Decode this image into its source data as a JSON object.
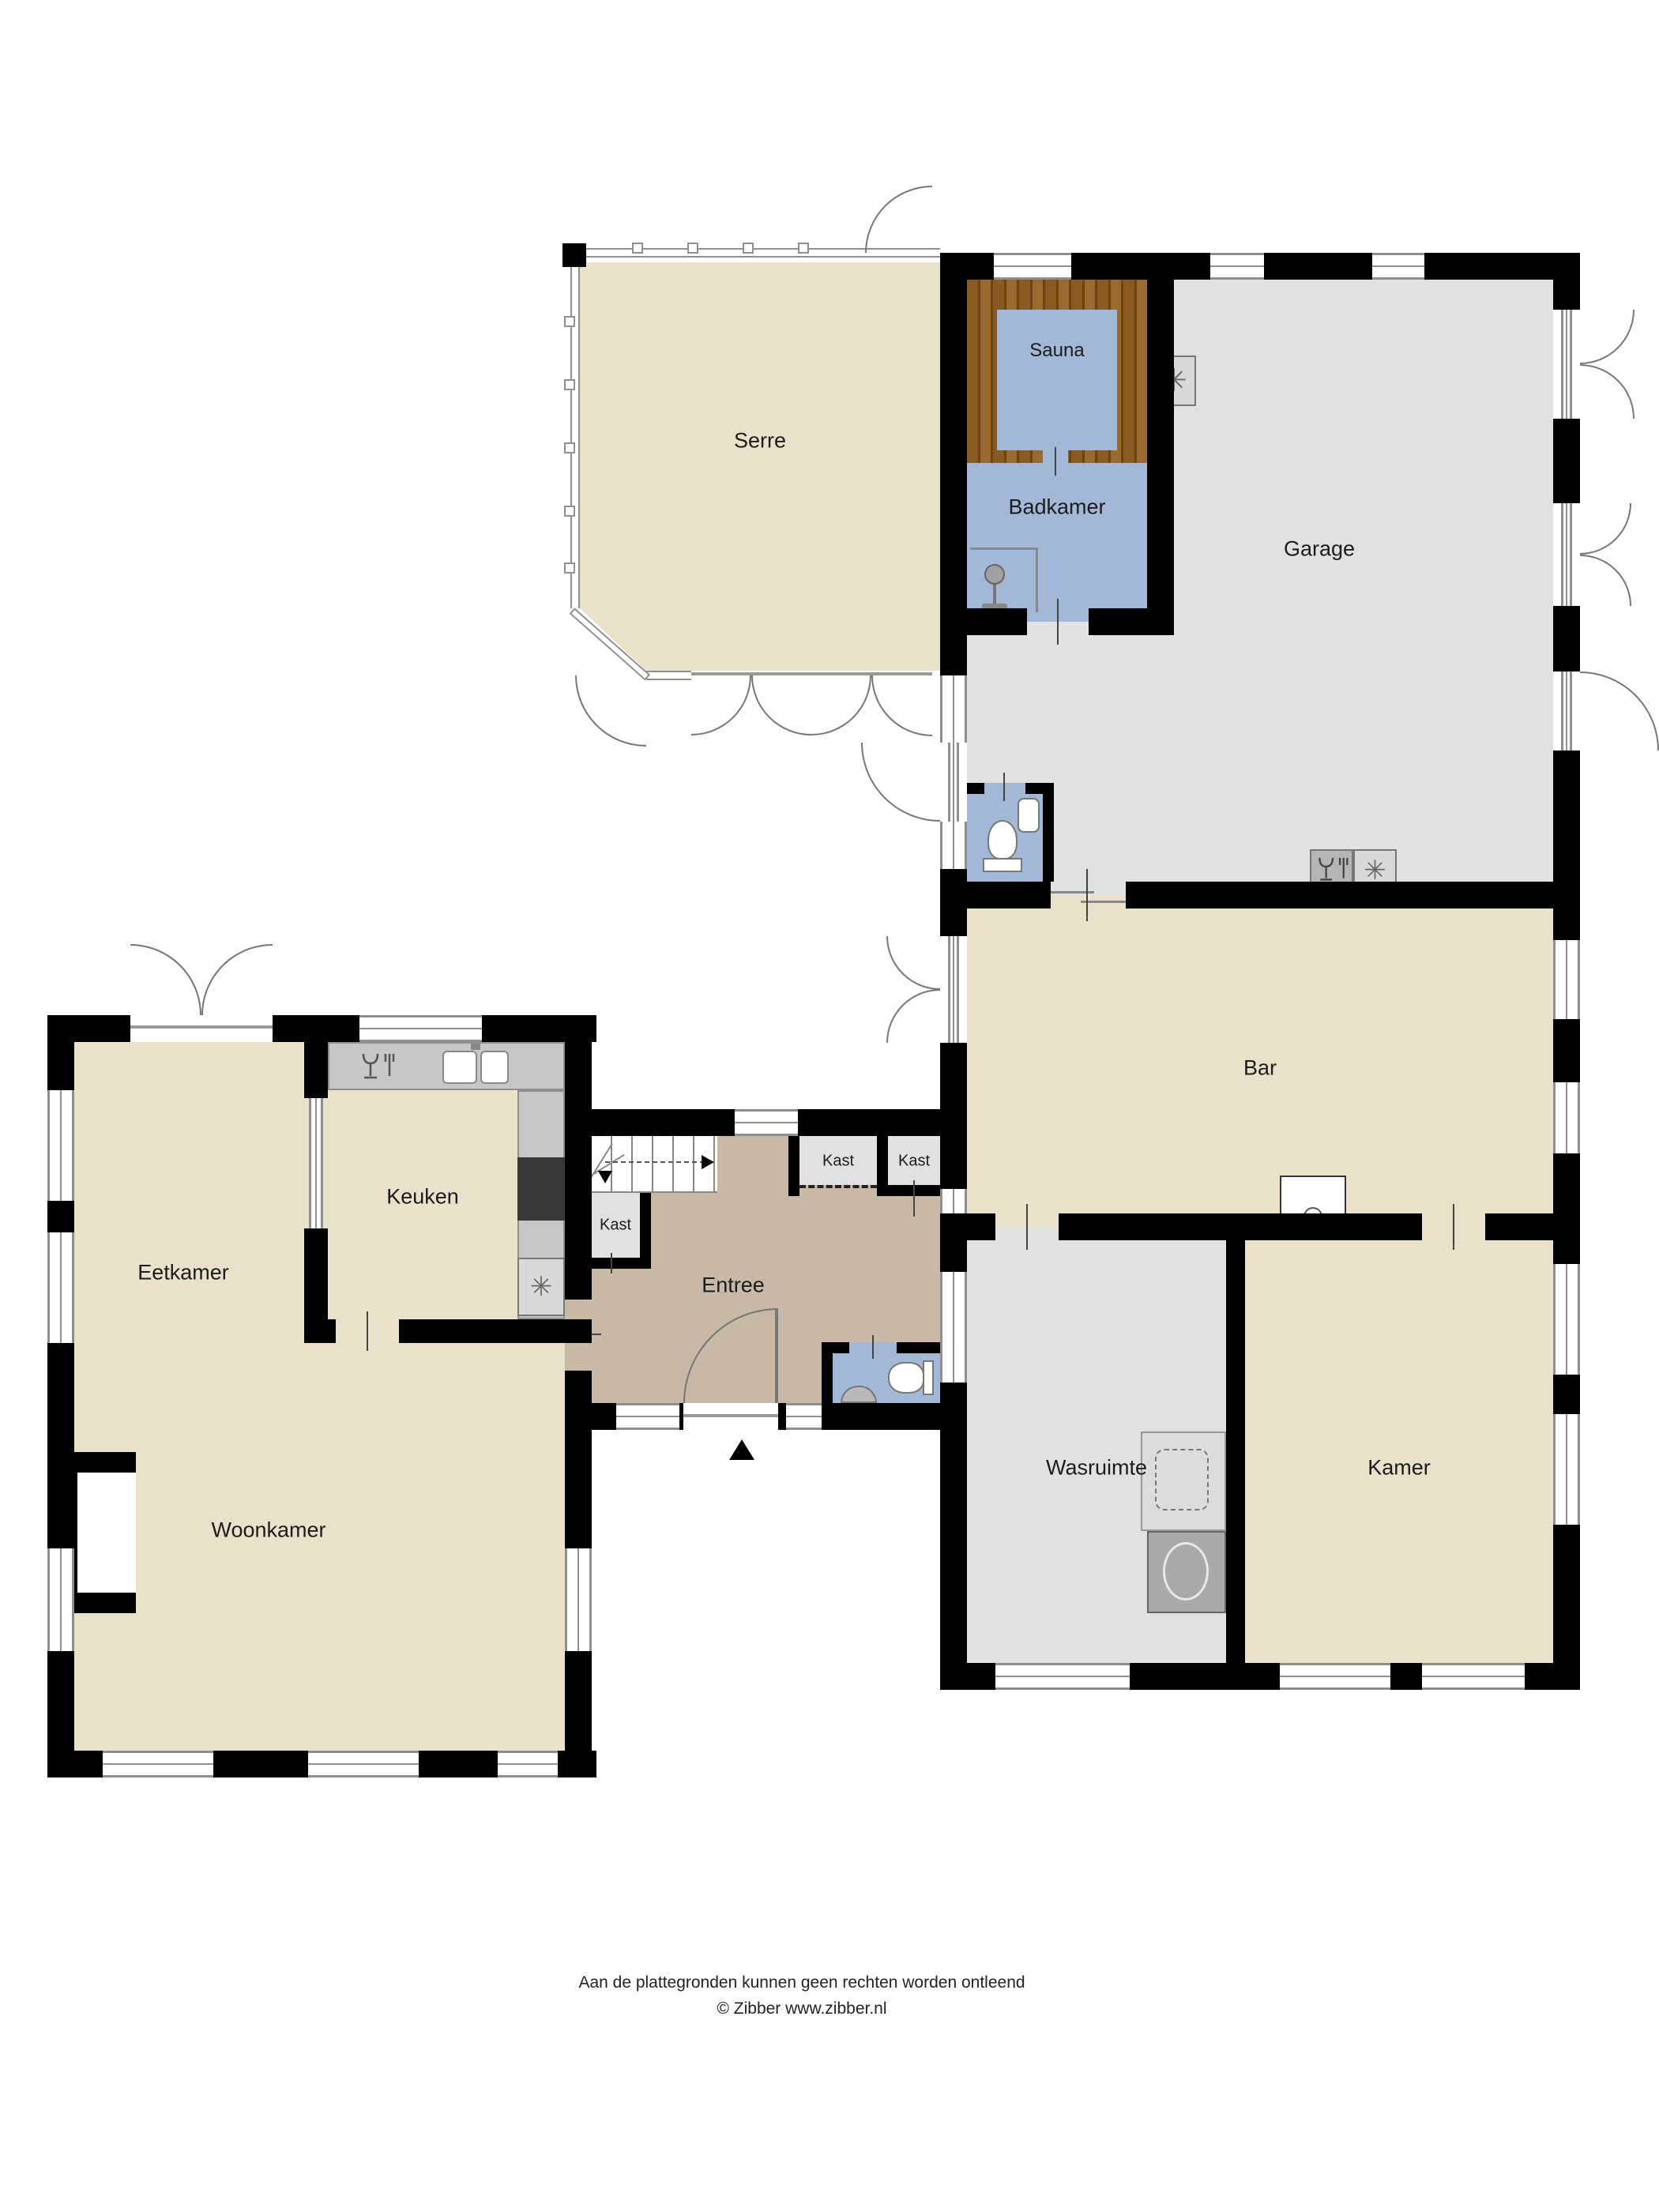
{
  "plan": {
    "rooms": {
      "serre": {
        "label": "Serre"
      },
      "sauna": {
        "label": "Sauna"
      },
      "badkamer": {
        "label": "Badkamer"
      },
      "garage": {
        "label": "Garage"
      },
      "bar": {
        "label": "Bar"
      },
      "kast_stairs": {
        "label": "Kast"
      },
      "kast_hall_left": {
        "label": "Kast"
      },
      "kast_hall_right": {
        "label": "Kast"
      },
      "keuken": {
        "label": "Keuken"
      },
      "eetkamer": {
        "label": "Eetkamer"
      },
      "entree": {
        "label": "Entree"
      },
      "wasruimte": {
        "label": "Wasruimte"
      },
      "kamer": {
        "label": "Kamer"
      },
      "woonkamer": {
        "label": "Woonkamer"
      }
    },
    "icons": {
      "freezer": {
        "name": "snowflake-icon",
        "glyph": "✳"
      },
      "dishwasher": {
        "name": "dishwasher-icon",
        "glyph": "glass-and-fork"
      },
      "shower": {
        "name": "shower-icon",
        "glyph": "css-shape"
      },
      "toilet": {
        "name": "toilet-icon",
        "glyph": "css-shape"
      },
      "sink": {
        "name": "sink-icon",
        "glyph": "css-shape"
      },
      "washer": {
        "name": "washing-machine-icon",
        "glyph": "css-shape"
      },
      "stairs_arrow": {
        "name": "stairs-direction-arrow",
        "glyph": "css-shape"
      },
      "entrance_arrow": {
        "name": "entrance-marker-arrow",
        "glyph": "css-shape"
      },
      "fireplace": {
        "name": "fireplace-niche",
        "glyph": "css-shape"
      }
    },
    "colors": {
      "cream": "#e9e1ca",
      "taupe": "#c8b9a6",
      "blue": "#a3b8d6",
      "floorgray": "#e1e1e1",
      "wood1": "#8a5a22",
      "wood2": "#6e4312",
      "wall": "#000000",
      "winline": "#8f8f8f",
      "counter": "#c7c7c7",
      "appl": "#b5b5b5",
      "stove": "#383838",
      "arc": "#777777",
      "text": "#1c1c1c"
    },
    "footer": {
      "line1": "Aan de plattegronden kunnen geen rechten worden ontleend",
      "line2": "© Zibber www.zibber.nl"
    }
  }
}
